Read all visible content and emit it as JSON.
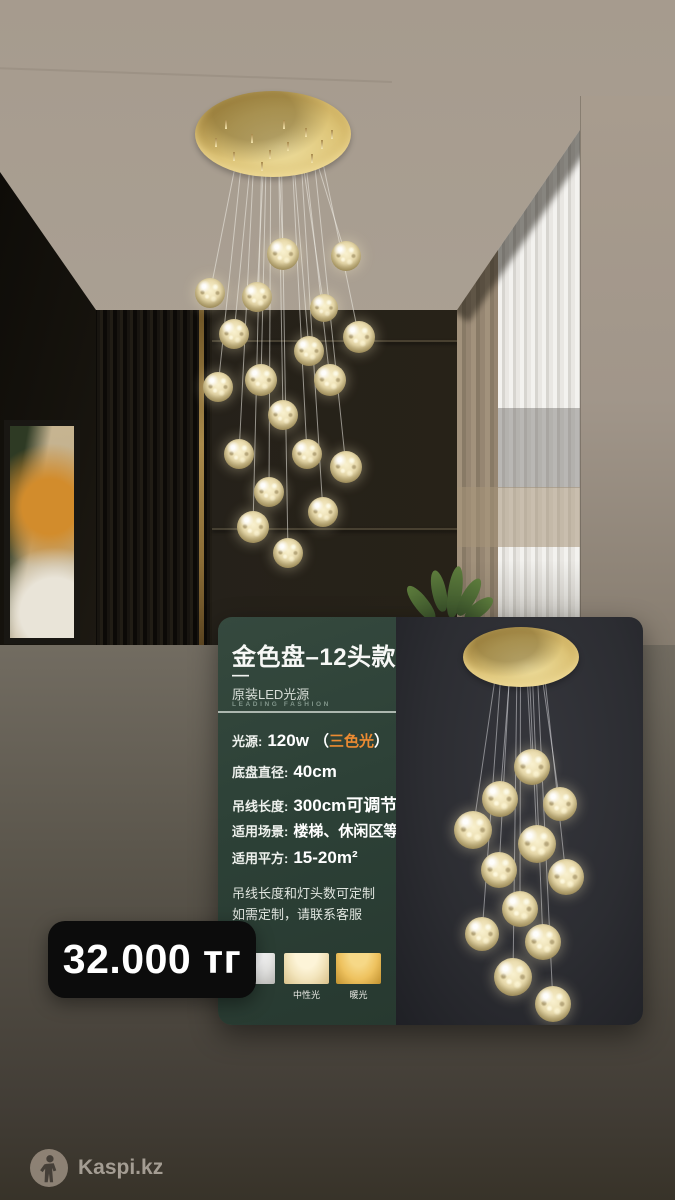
{
  "price": {
    "text": "32.000 тг"
  },
  "footer": {
    "brand": "Kaspi.kz"
  },
  "colors": {
    "accent_orange": "#ed8b32",
    "card_green": "#2d4137",
    "price_bg": "#0c0c0c",
    "gold": "#d8bc6d"
  },
  "product_card": {
    "title": "金色盘–12头款",
    "divider_dash": "—",
    "subtitle": "原装LED光源",
    "tagline": "LEADING FASHION",
    "specs": [
      {
        "label": "光源:",
        "value": "120w",
        "bracket_open": "（",
        "highlight": "三色光",
        "bracket_close": "）"
      },
      {
        "label": "底盘直径:",
        "value": "40cm",
        "bracket_open": "",
        "highlight": "",
        "bracket_close": ""
      },
      {
        "label": "吊线长度:",
        "value": "300cm可调节",
        "bracket_open": "",
        "highlight": "",
        "bracket_close": ""
      },
      {
        "label": "适用场景:",
        "value": "楼梯、休闲区等",
        "bracket_open": "",
        "highlight": "",
        "bracket_close": ""
      },
      {
        "label": "适用平方:",
        "value": "15-20m²",
        "bracket_open": "",
        "highlight": "",
        "bracket_close": ""
      }
    ],
    "notes": [
      "吊线长度和灯头数可定制",
      "如需定制，请联系客服"
    ],
    "swatches": [
      {
        "label": "",
        "tone": "white"
      },
      {
        "label": "中性光",
        "tone": "neutral"
      },
      {
        "label": "暖光",
        "tone": "warm"
      }
    ]
  }
}
